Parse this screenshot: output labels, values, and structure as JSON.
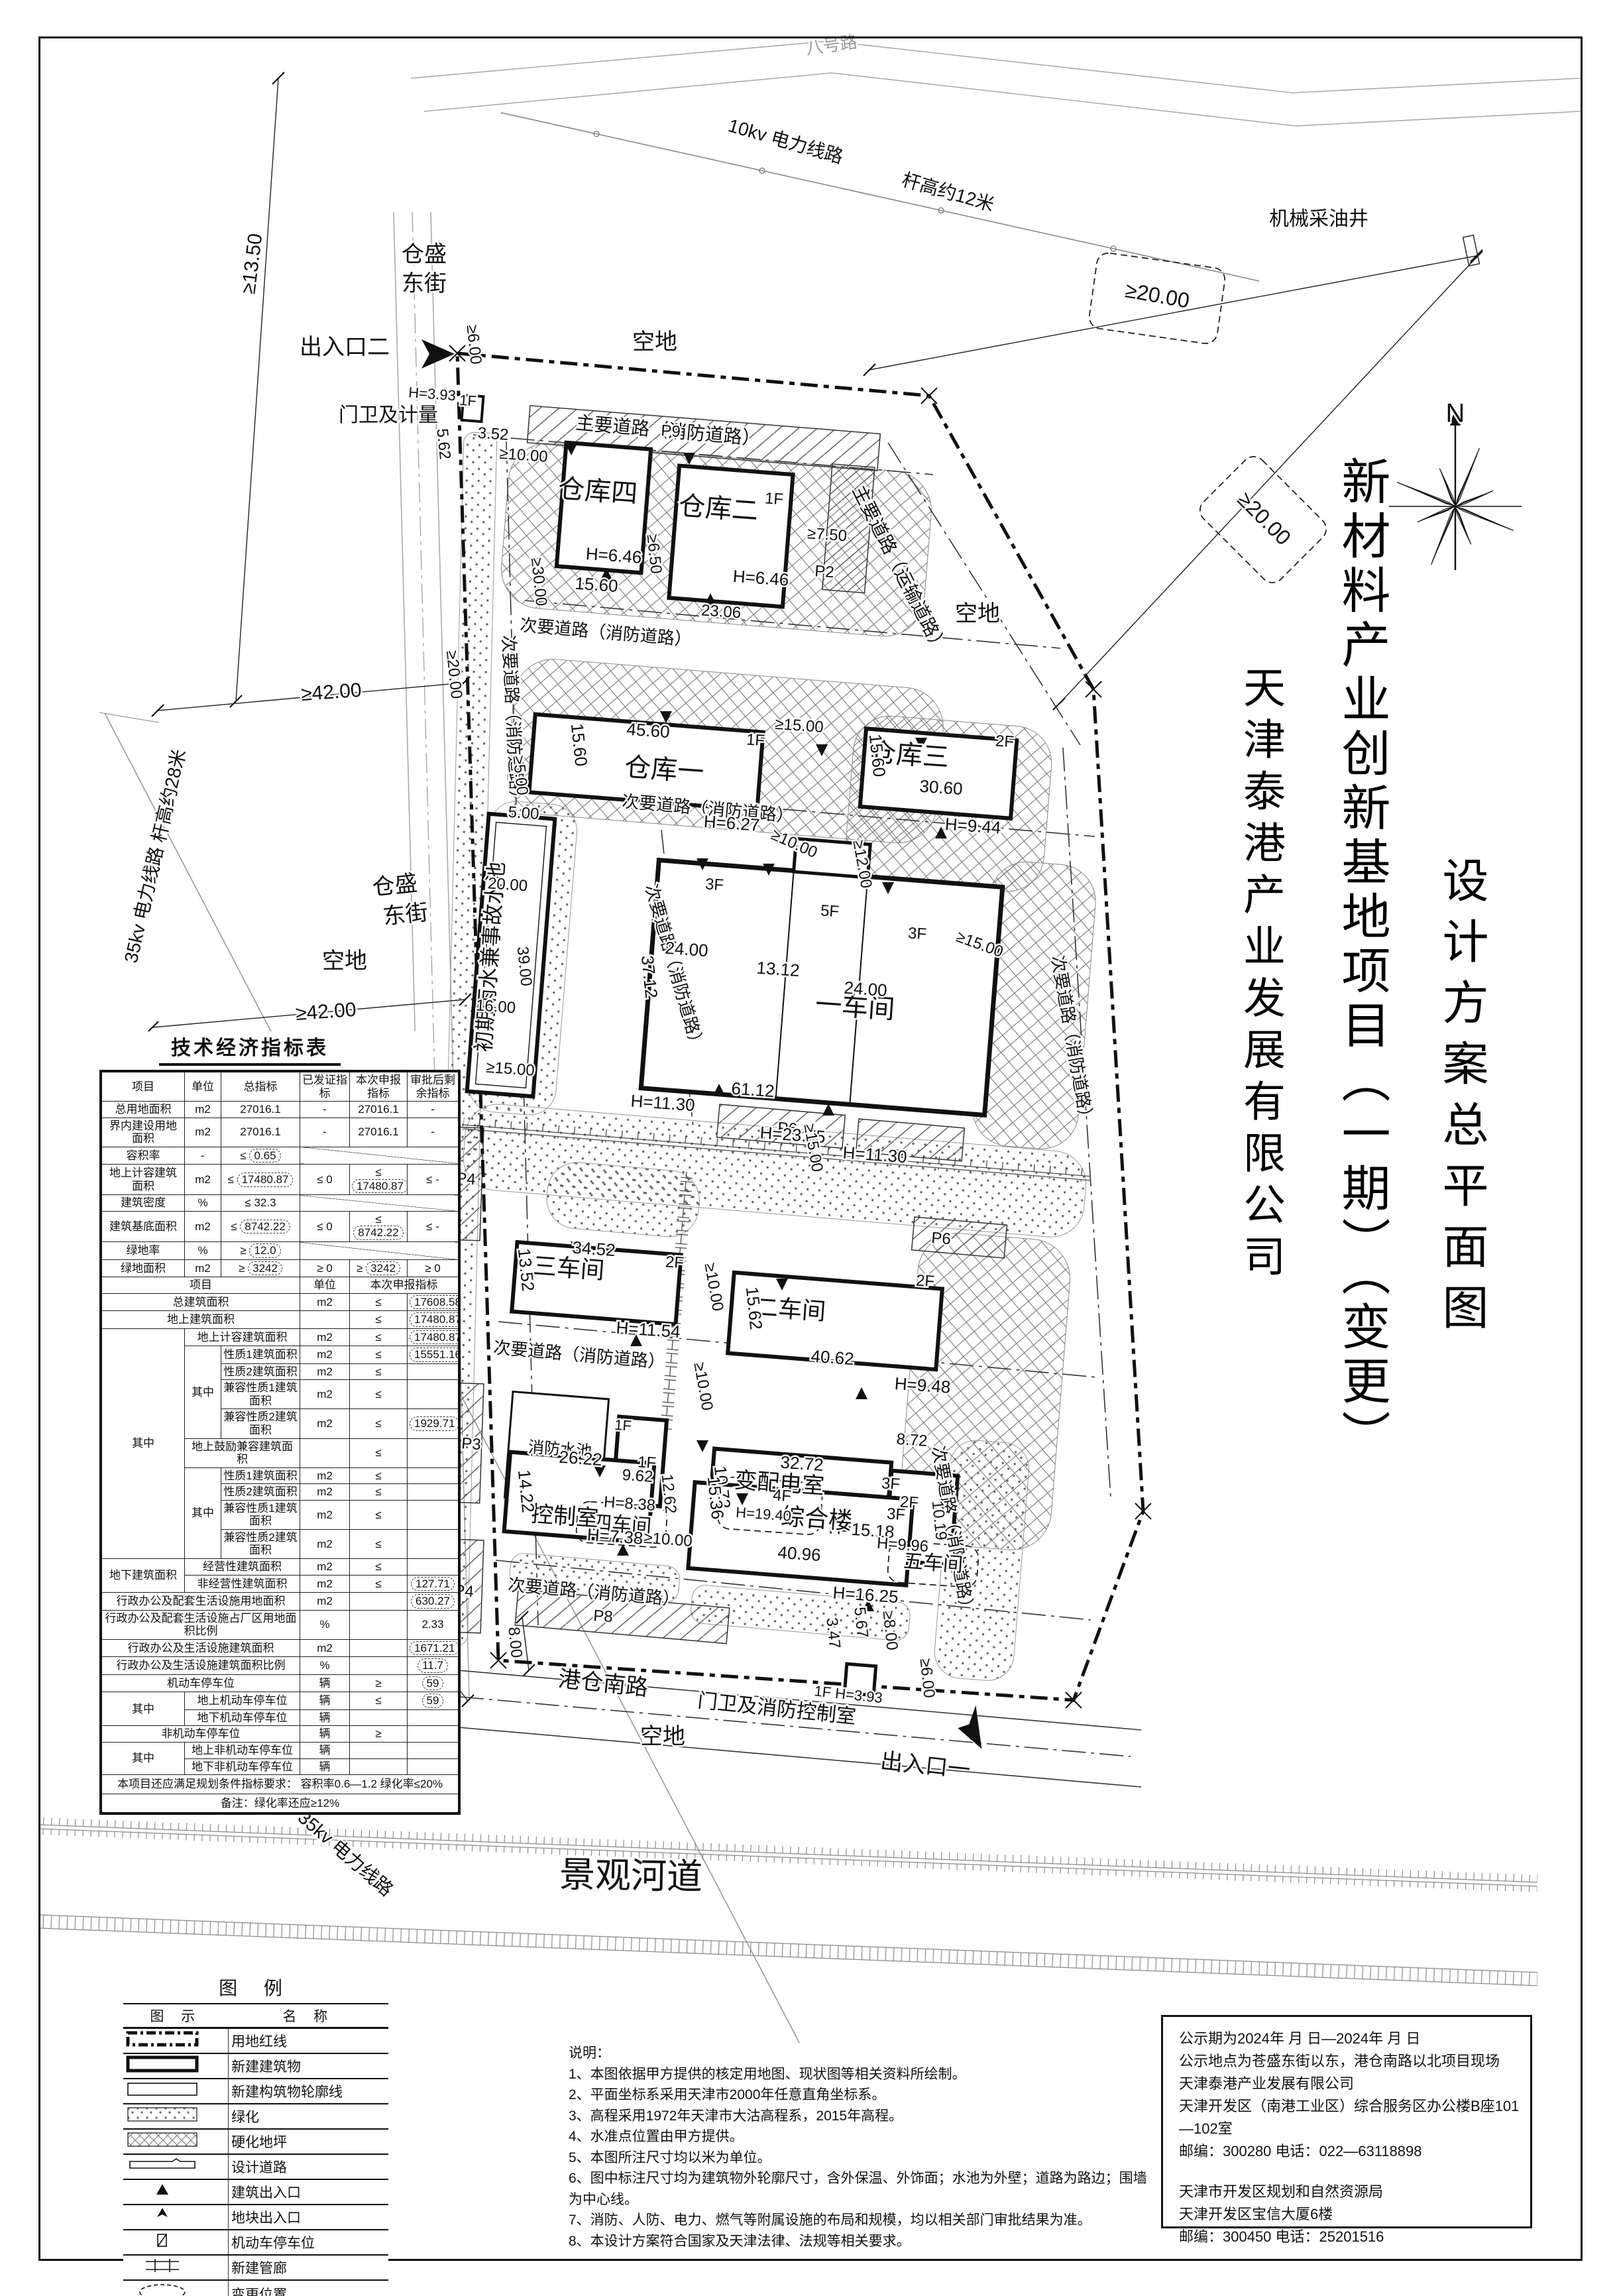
{
  "title_block": {
    "project_title": "新材料产业创新基地项目（一期）（变更）",
    "company": "天津泰港产业发展有限公司",
    "drawing_title": "设计方案总平面图"
  },
  "indicator_table": {
    "title": "技术经济指标表",
    "head": [
      "项目",
      "单位",
      "总指标",
      "已发证指标",
      "本次申报指标",
      "审批后剩余指标"
    ],
    "part1_rows": [
      [
        "总用地面积",
        "m2",
        "27016.1",
        "-",
        "27016.1",
        "-"
      ],
      [
        "界内建设用地面积",
        "m2",
        "27016.1",
        "-",
        "27016.1",
        "-"
      ],
      [
        "容积率",
        "-",
        "≤ [0.65]",
        "/",
        "",
        ""
      ],
      [
        "地上计容建筑面积",
        "m2",
        "≤ [17480.87]",
        "≤ 0",
        "≤ [17480.87]",
        "≤ -"
      ],
      [
        "建筑密度",
        "%",
        "≤ 32.3",
        "/",
        "",
        ""
      ],
      [
        "建筑基底面积",
        "m2",
        "≤ [8742.22]",
        "≤ 0",
        "≤ [8742.22]",
        "≤ -"
      ],
      [
        "绿地率",
        "%",
        "≥ [12.0]",
        "/",
        "",
        ""
      ],
      [
        "绿地面积",
        "m2",
        "≥ [3242]",
        "≥ 0",
        "≥ [3242]",
        "≥ 0"
      ]
    ],
    "mid_head": [
      "项目",
      "单位",
      "本次申报指标"
    ],
    "part2_rows": [
      [
        "总建筑面积",
        "m2",
        "≤",
        "[17608.58]"
      ],
      [
        "地上建筑面积",
        "",
        "≤",
        "[17480.87]"
      ],
      [
        "地上计容建筑面积",
        "m2",
        "≤",
        "[17480.87]"
      ],
      [
        "性质1建筑面积",
        "m2",
        "≤",
        "[15551.16]"
      ],
      [
        "性质2建筑面积",
        "m2",
        "≤",
        ""
      ],
      [
        "兼容性质1建筑面积",
        "m2",
        "≤",
        ""
      ],
      [
        "兼容性质2建筑面积",
        "m2",
        "≤",
        "[1929.71]"
      ],
      [
        "地上鼓励兼容建筑面积",
        "",
        "≤",
        ""
      ],
      [
        "性质1建筑面积",
        "m2",
        "≤",
        ""
      ],
      [
        "性质2建筑面积",
        "m2",
        "≤",
        ""
      ],
      [
        "兼容性质1建筑面积",
        "m2",
        "≤",
        ""
      ],
      [
        "兼容性质2建筑面积",
        "m2",
        "≤",
        ""
      ],
      [
        "经营性建筑面积",
        "m2",
        "≤",
        ""
      ],
      [
        "非经营性建筑面积",
        "m2",
        "≤",
        "[127.71]"
      ],
      [
        "行政办公及配套生活设施用地面积",
        "m2",
        "",
        "[630.27]"
      ],
      [
        "行政办公及配套生活设施占厂区用地面积比例",
        "%",
        "",
        "2.33"
      ],
      [
        "行政办公及生活设施建筑面积",
        "m2",
        "",
        "[1671.21]"
      ],
      [
        "行政办公及生活设施建筑面积比例",
        "%",
        "",
        "[11.7]"
      ],
      [
        "机动车停车位",
        "辆",
        "≥",
        "[59]"
      ],
      [
        "地上机动车停车位",
        "辆",
        "≤",
        "[59]"
      ],
      [
        "地下机动车停车位",
        "辆",
        "",
        ""
      ],
      [
        "非机动车停车位",
        "辆",
        "≥",
        ""
      ],
      [
        "地上非机动车停车位",
        "辆",
        "",
        ""
      ],
      [
        "地下非机动车停车位",
        "辆",
        "",
        ""
      ]
    ],
    "group_labels": {
      "r2": "其中",
      "r3": "其中",
      "r8": "其中",
      "r12": "地下建筑面积",
      "r19": "其中",
      "r22": "其中"
    },
    "footer_lines": [
      "本项目还应满足规划条件指标要求：  容积率0.6—1.2   绿化率≤20%",
      "备注：绿化率还应≥12%"
    ]
  },
  "legend": {
    "title": "图 例",
    "col_symbol": "图  示",
    "col_name": "名  称",
    "items": [
      {
        "sym": "red-line",
        "label": "用地红线"
      },
      {
        "sym": "new-building",
        "label": "新建建筑物"
      },
      {
        "sym": "structure-outline",
        "label": "新建构筑物轮廓线"
      },
      {
        "sym": "greenery",
        "label": "绿化"
      },
      {
        "sym": "paving",
        "label": "硬化地坪"
      },
      {
        "sym": "design-road",
        "label": "设计道路"
      },
      {
        "sym": "building-entrance",
        "label": "建筑出入口"
      },
      {
        "sym": "site-entrance",
        "label": "地块出入口"
      },
      {
        "sym": "parking-space",
        "label": "机动车停车位"
      },
      {
        "sym": "pipe-gallery",
        "label": "新建管廊"
      },
      {
        "sym": "change-location",
        "label": "变更位置"
      }
    ]
  },
  "notes": {
    "title": "说明：",
    "items": [
      "1、本图依据甲方提供的核定用地图、现状图等相关资料所绘制。",
      "2、平面坐标系采用天津市2000年任意直角坐标系。",
      "3、高程采用1972年天津市大沽高程系，2015年高程。",
      "4、水准点位置由甲方提供。",
      "5、本图所注尺寸均以米为单位。",
      "6、图中标注尺寸均为建筑物外轮廓尺寸，含外保温、外饰面；水池为外壁；道路为路边；围墙为中心线。",
      "7、消防、人防、电力、燃气等附属设施的布局和规模，均以相关部门审批结果为准。",
      "8、本设计方案符合国家及天津法律、法规等相关要求。"
    ]
  },
  "publicity": {
    "lines": [
      "公示期为2024年  月  日—2024年  月  日",
      "公示地点为苍盛东街以东，港仓南路以北项目现场",
      "天津泰港产业发展有限公司",
      "天津开发区（南港工业区）综合服务区办公楼B座101—102室",
      "邮编：300280   电话：022—63118898",
      "",
      "天津市开发区规划和自然资源局",
      "天津开发区宝信大厦6楼",
      "邮编：300450   电话：25201516"
    ]
  },
  "plan": {
    "labels": [
      "八号路",
      "10kv 电力线路",
      "杆高约12米",
      "机械采油井",
      "仓盛",
      "东街",
      "仓盛",
      "东街",
      "空地",
      "空地",
      "空地",
      "空地",
      "35kv 电力线路 杆高约28米",
      "35kv 电力线路",
      "港仓南路",
      "景观河道",
      "≥13.50",
      "≥20.00",
      "≥20.00",
      "≥42.00",
      "≥42.00",
      "≥10.00",
      "8.00",
      "N",
      "出入口二",
      "出入口一",
      "主要道路（消防道路）",
      "主要道路（运输道路）",
      "次要道路（消防道路）",
      "次要道路（消防道路）",
      "次要道路（消防道路）",
      "次要道路（消防道路）",
      "次要道路（消防道路）",
      "次要道路（消防道路）",
      "次要道路（消防道路）",
      "次要道路（消防道路）",
      "次要道路（消防道路）",
      "P9",
      "P2",
      "P3",
      "P4",
      "P4",
      "P6",
      "P4",
      "P6",
      "P8",
      "门卫及计量",
      "H=3.93",
      "1F",
      "3.52",
      "5.62",
      "≥6.00",
      "仓库四",
      "H=6.46",
      "15.60",
      "≥10.00",
      "≥30.00",
      "≥6.50",
      "仓库二",
      "1F",
      "H=6.46",
      "23.06",
      "≥7.50",
      "≥5.00",
      "仓库一",
      "45.60",
      "15.60",
      "1F",
      "H=6.27",
      "≥15.00",
      "≥10.00",
      "仓库三",
      "2F",
      "30.60",
      "H=9.44",
      "15.60",
      "≥12.00",
      "≥15.00",
      "≥20.00",
      "初期雨水兼事故水池",
      "5.00",
      "20.00",
      "39.00",
      "16.00",
      "≥15.00",
      "一车间",
      "3F",
      "5F",
      "3F",
      "24.00",
      "13.12",
      "24.00",
      "37.12",
      "61.12",
      "H=11.30",
      "H=23.75",
      "H=11.30",
      "6.00",
      "≥15.00",
      "三车间",
      "34.52",
      "13.52",
      "2F",
      "H=11.54",
      "≥10.00",
      "二车间",
      "2F",
      "15.62",
      "40.62",
      "H=9.48",
      "≥10.00",
      "消防水池",
      "四车间",
      "1F",
      "9.62",
      "12.62",
      "H=8.38",
      "变配电室",
      "32.72",
      "10.72",
      "3F",
      "H=15.18",
      "8.72",
      "2F",
      "H=9.96",
      "10.19",
      "五车间",
      "控制室",
      "26.22",
      "1F",
      "14.22",
      "H=7.38",
      "≥10.00",
      "综合楼",
      "3F",
      "15.36",
      "40.96",
      "H=16.25",
      "4F",
      "H=19.40",
      "5.67",
      "3.47",
      "≥8.00",
      "≥6.00",
      "门卫及消防控制室",
      "1F H=3.93"
    ]
  }
}
